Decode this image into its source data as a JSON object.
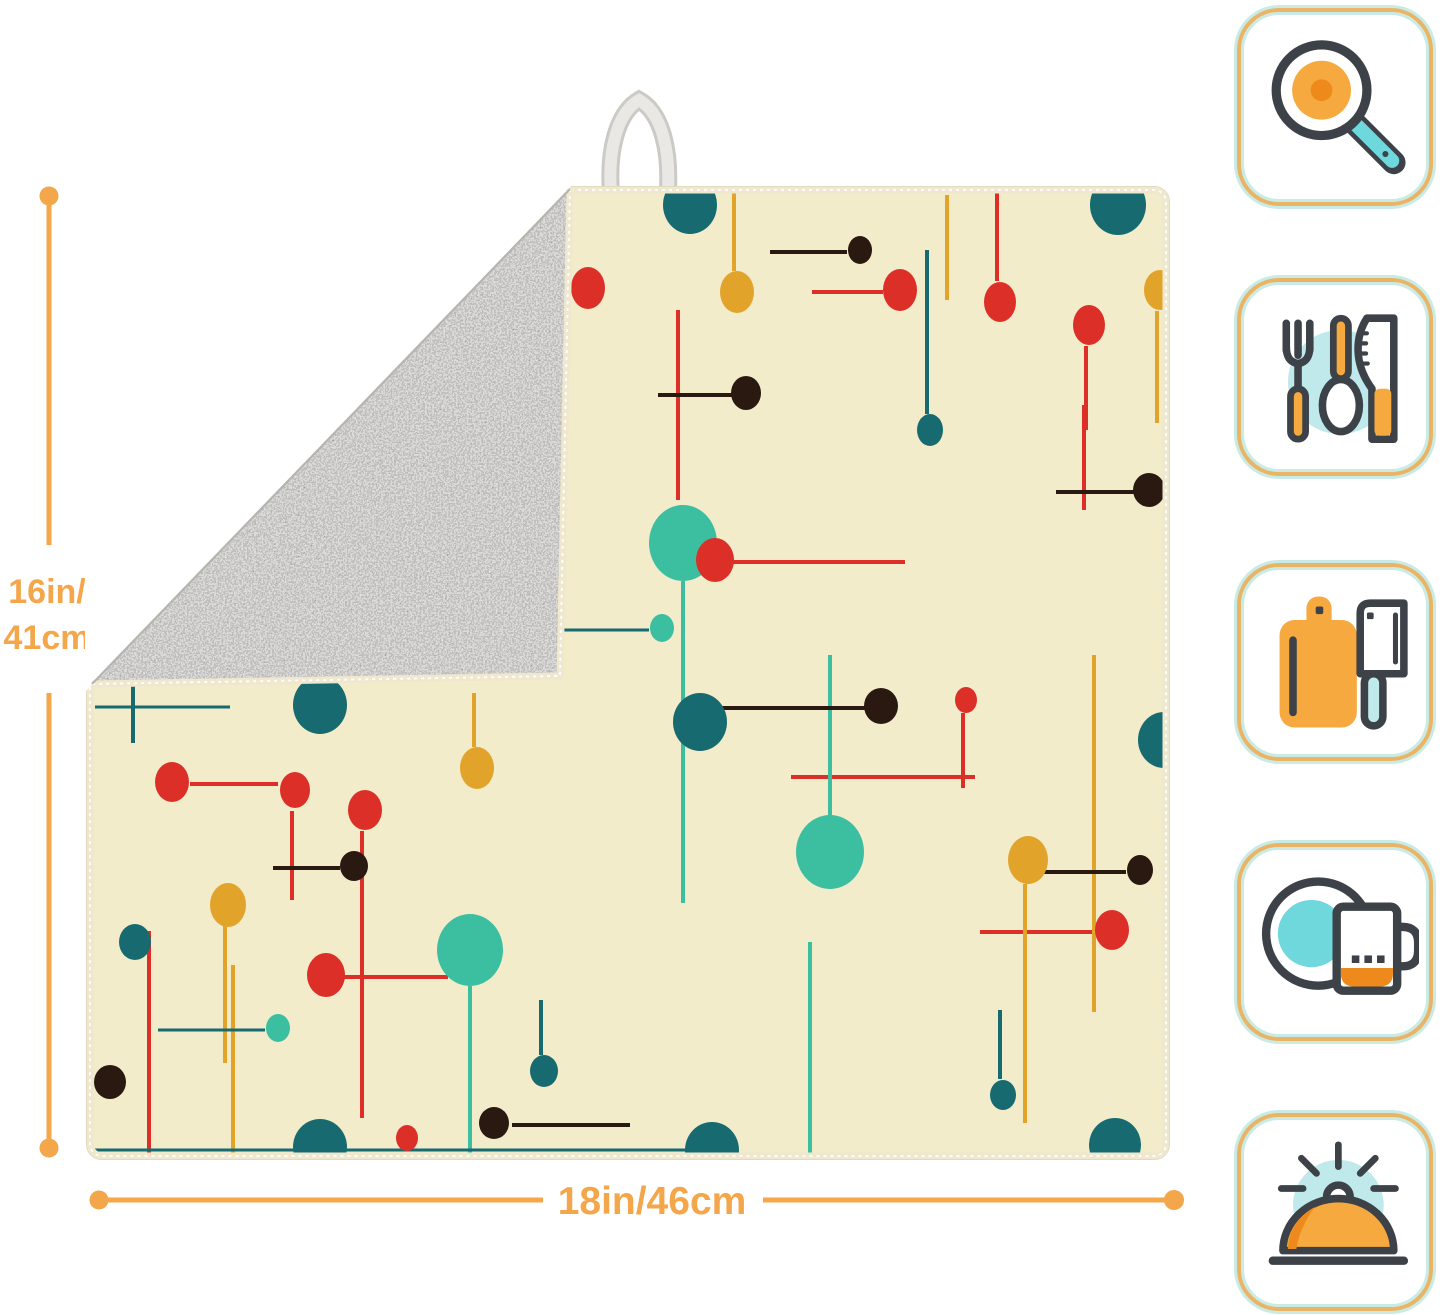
{
  "dimensions": {
    "height_label_line1": "16in/",
    "height_label_line2": "41cm",
    "width_label": "18in/46cm"
  },
  "colors": {
    "dimension_accent": "#F3A64A",
    "icon_ink": "#3D4249",
    "icon_orange": "#F6A93E",
    "icon_orange_dark": "#EE8A1B",
    "icon_teal": "#6ED8DC",
    "icon_teal_bg": "#BFE9EA",
    "badge_border": "#E9B466",
    "badge_ring": "#C9EBE5",
    "mat_front": "#F2ECCB",
    "mat_back": "#ABAAA6",
    "mat_binding": "#EFE8CF",
    "loop": "#E9E8E4"
  },
  "mat": {
    "description": "dish drying mat, mid-century atomic pattern, gray microfiber back folded at top-left corner, hanging loop",
    "palette": {
      "teal": "#176B70",
      "red": "#DC2F28",
      "mustard": "#E2A32A",
      "black": "#2A1911",
      "mint": "#3CBFA0"
    },
    "pattern": {
      "dots": [
        [
          602,
          17,
          27,
          29,
          "teal"
        ],
        [
          1030,
          17,
          28,
          30,
          "teal"
        ],
        [
          232,
          517,
          27,
          29,
          "teal"
        ],
        [
          612,
          534,
          27,
          29,
          "teal"
        ],
        [
          1076,
          552,
          26,
          28,
          "teal"
        ],
        [
          232,
          959,
          27,
          28,
          "teal"
        ],
        [
          624,
          962,
          27,
          28,
          "teal"
        ],
        [
          1027,
          957,
          26,
          27,
          "teal"
        ],
        [
          595,
          355,
          34,
          38,
          "mint"
        ],
        [
          382,
          762,
          33,
          36,
          "mint"
        ],
        [
          742,
          664,
          34,
          37,
          "mint"
        ],
        [
          812,
          102,
          17,
          21,
          "red"
        ],
        [
          912,
          114,
          16,
          20,
          "red"
        ],
        [
          84,
          594,
          17,
          20,
          "red"
        ],
        [
          207,
          602,
          15,
          18,
          "red"
        ],
        [
          277,
          622,
          17,
          20,
          "red"
        ],
        [
          627,
          372,
          19,
          22,
          "red"
        ],
        [
          238,
          787,
          19,
          22,
          "red"
        ],
        [
          1001,
          137,
          16,
          20,
          "red"
        ],
        [
          1024,
          742,
          17,
          20,
          "red"
        ],
        [
          500,
          100,
          17,
          21,
          "red"
        ],
        [
          878,
          512,
          11,
          13,
          "red"
        ],
        [
          319,
          950,
          11,
          13,
          "red"
        ],
        [
          649,
          104,
          17,
          21,
          "mustard"
        ],
        [
          1072,
          102,
          16,
          20,
          "mustard"
        ],
        [
          140,
          717,
          18,
          22,
          "mustard"
        ],
        [
          389,
          580,
          17,
          21,
          "mustard"
        ],
        [
          940,
          672,
          20,
          24,
          "mustard"
        ],
        [
          772,
          62,
          12,
          14,
          "black"
        ],
        [
          658,
          205,
          15,
          17,
          "black"
        ],
        [
          266,
          678,
          14,
          15,
          "black"
        ],
        [
          793,
          518,
          17,
          18,
          "black"
        ],
        [
          1061,
          302,
          16,
          17,
          "black"
        ],
        [
          406,
          935,
          15,
          16,
          "black"
        ],
        [
          1052,
          682,
          13,
          15,
          "black"
        ],
        [
          22,
          894,
          16,
          17,
          "black"
        ],
        [
          842,
          242,
          13,
          16,
          "teal"
        ],
        [
          47,
          754,
          16,
          18,
          "teal"
        ],
        [
          456,
          883,
          14,
          16,
          "teal"
        ],
        [
          915,
          907,
          13,
          15,
          "teal"
        ],
        [
          574,
          440,
          12,
          14,
          "mint"
        ],
        [
          190,
          840,
          12,
          14,
          "mint"
        ]
      ],
      "lines": [
        [
          724,
          104,
          795,
          104,
          "red",
          4
        ],
        [
          909,
          2,
          909,
          93,
          "red",
          4
        ],
        [
          102,
          596,
          190,
          596,
          "red",
          4
        ],
        [
          204,
          623,
          204,
          712,
          "red",
          4
        ],
        [
          274,
          643,
          274,
          930,
          "red",
          4
        ],
        [
          645,
          374,
          817,
          374,
          "red",
          4
        ],
        [
          256,
          789,
          360,
          789,
          "red",
          4
        ],
        [
          998,
          158,
          998,
          242,
          "red",
          4
        ],
        [
          892,
          744,
          1006,
          744,
          "red",
          4
        ],
        [
          875,
          525,
          875,
          600,
          "red",
          4
        ],
        [
          590,
          122,
          590,
          312,
          "red",
          4
        ],
        [
          996,
          217,
          996,
          322,
          "red",
          4
        ],
        [
          61,
          743,
          61,
          967,
          "red",
          4
        ],
        [
          703,
          589,
          887,
          589,
          "red",
          4
        ],
        [
          646,
          2,
          646,
          83,
          "mustard",
          4
        ],
        [
          1069,
          123,
          1069,
          235,
          "mustard",
          4
        ],
        [
          937,
          696,
          937,
          935,
          "mustard",
          4
        ],
        [
          137,
          738,
          137,
          875,
          "mustard",
          4
        ],
        [
          386,
          505,
          386,
          559,
          "mustard",
          4
        ],
        [
          859,
          7,
          859,
          112,
          "mustard",
          4
        ],
        [
          145,
          777,
          145,
          967,
          "mustard",
          4
        ],
        [
          1006,
          467,
          1006,
          824,
          "mustard",
          4
        ],
        [
          595,
          393,
          595,
          715,
          "mint",
          4
        ],
        [
          382,
          798,
          382,
          967,
          "mint",
          4
        ],
        [
          742,
          467,
          742,
          630,
          "mint",
          4
        ],
        [
          722,
          754,
          722,
          967,
          "mint",
          4
        ],
        [
          839,
          62,
          839,
          226,
          "teal",
          4
        ],
        [
          453,
          812,
          453,
          867,
          "teal",
          4
        ],
        [
          912,
          822,
          912,
          891,
          "teal",
          4
        ],
        [
          457,
          442,
          561,
          442,
          "teal",
          3
        ],
        [
          70,
          842,
          177,
          842,
          "teal",
          3
        ],
        [
          45,
          377,
          45,
          555,
          "teal",
          4
        ],
        [
          7,
          519,
          142,
          519,
          "teal",
          3
        ],
        [
          7,
          962,
          610,
          962,
          "teal",
          3
        ],
        [
          682,
          64,
          759,
          64,
          "black",
          4
        ],
        [
          570,
          207,
          644,
          207,
          "black",
          4
        ],
        [
          185,
          680,
          252,
          680,
          "black",
          4
        ],
        [
          615,
          520,
          779,
          520,
          "black",
          4
        ],
        [
          968,
          304,
          1047,
          304,
          "black",
          4
        ],
        [
          424,
          937,
          542,
          937,
          "black",
          4
        ],
        [
          947,
          684,
          1038,
          684,
          "black",
          4
        ]
      ]
    }
  },
  "icons": [
    {
      "alt": "frying pan with fried egg"
    },
    {
      "alt": "fork, spoon and knife"
    },
    {
      "alt": "cutting board and cleaver"
    },
    {
      "alt": "plate and mug"
    },
    {
      "alt": "serving cloche"
    }
  ]
}
